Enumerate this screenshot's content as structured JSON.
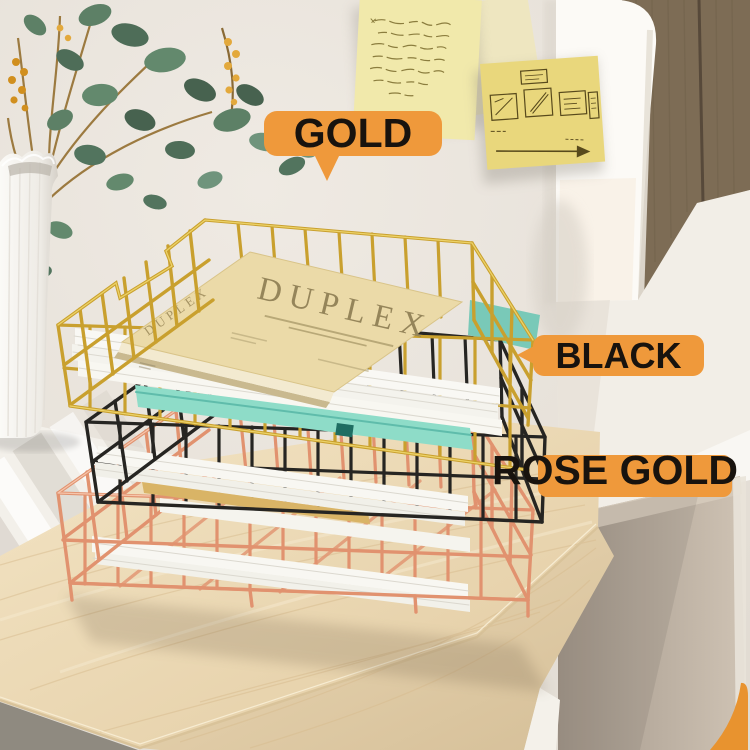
{
  "image_type": "product-photo",
  "callouts": {
    "gold": "GOLD",
    "black": "BLACK",
    "rose_gold": "ROSE GOLD",
    "bubble_color": "#EF993B",
    "text_color": "#18130E"
  },
  "book": {
    "title": "DUPLEX"
  },
  "trays": [
    {
      "name": "gold-tray",
      "label": "GOLD",
      "wire_color": "#C9A02E"
    },
    {
      "name": "black-tray",
      "label": "BLACK",
      "wire_color": "#262522"
    },
    {
      "name": "rose-gold-tray",
      "label": "ROSE GOLD",
      "wire_color": "#E1926F"
    }
  ],
  "sticky_notes": [
    {
      "name": "handwritten-note",
      "color": "#F1E9AB"
    },
    {
      "name": "sketch-note",
      "color": "#E9D77C"
    }
  ],
  "scene_colors": {
    "wall": "#E9E4DC",
    "desk_wood": "#EBD8B5",
    "side_panel": "#B3A797",
    "wood_wall_panel": "#7D6C55",
    "teal_folder": "#8EDCC8",
    "gold_paper": "#D9B466"
  }
}
